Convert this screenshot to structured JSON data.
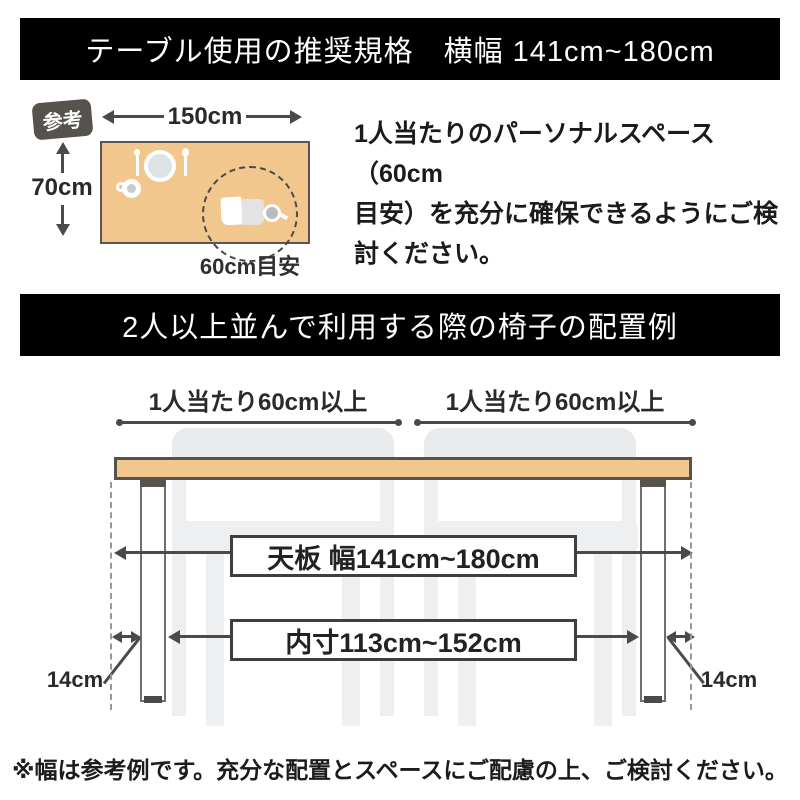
{
  "banner_top": {
    "title": "テーブル使用の推奨規格　横幅 141cm~180cm"
  },
  "reference": {
    "badge_label": "参考",
    "table_width_label": "150cm",
    "table_depth_label": "70cm",
    "personal_space_label": "60cm目安",
    "note_lines": [
      "1人当たりのパーソナルスペース（60cm",
      "目安）を充分に確保できるようにご検",
      "討ください。"
    ]
  },
  "banner_middle": {
    "title": "2人以上並んで利用する際の椅子の配置例"
  },
  "diagram": {
    "per_person_label_left": "1人当たり60cm以上",
    "per_person_label_right": "1人当たり60cm以上",
    "tabletop_width_label": "天板 幅141cm~180cm",
    "inner_width_label": "内寸113cm~152cm",
    "leg_width_label_left": "14cm",
    "leg_width_label_right": "14cm"
  },
  "footer": {
    "note": "※幅は参考例です。充分な配置とスペースにご配慮の上、ご検討ください。"
  },
  "colors": {
    "banner_bg": "#000000",
    "banner_text": "#ffffff",
    "tabletop_fill": "#f1c78e",
    "tabletop_border": "#56524c",
    "badge_bg": "#56524e",
    "chair_fill": "#edeff0",
    "dimension_line": "#4a4a4a",
    "box_border": "#3f3f3f",
    "text": "#1f1f1f"
  },
  "icons": {
    "plate": "plate-icon",
    "fork": "fork-icon",
    "spoon": "spoon-icon",
    "cup": "cup-icon",
    "book": "book-icon",
    "magnifier": "magnifier-icon"
  }
}
